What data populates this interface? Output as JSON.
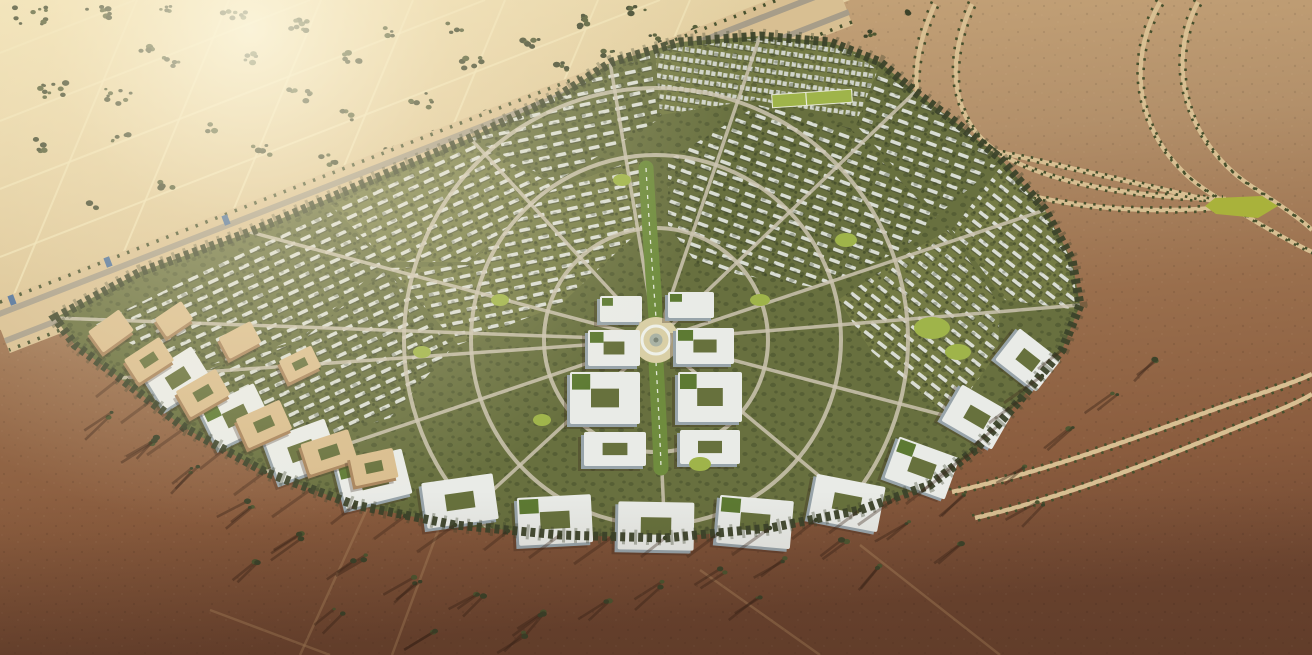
{
  "meta": {
    "type": "aerial-3d-render",
    "description": "Bird's-eye CGI rendering of a fan-shaped masterplanned desert community: dense white low-rise housing wedges with trees radiate from a circular central plaza and green promenade spine; large white office blocks line the southern arc; tan campus buildings on the west edge; a palm-lined highway corridor crosses the NW golden farm fields; S-curved tree-lined roads cross the NE desert to a small green interchange; dark red-brown desert with long tree shadows fills the south.",
    "width": 1312,
    "height": 655
  },
  "palette": {
    "desert_nw_light": "#eedfb2",
    "desert_nw": "#d2b787",
    "desert_ne": "#b3906a",
    "desert_s": "#8a5c3e",
    "desert_s_dark": "#6e4631",
    "field_line": "#efe2b6",
    "tree_dark": "#3c432a",
    "tree_mid": "#4d5631",
    "tree_shadow": "rgba(58,36,24,0.42)",
    "road_sand": "#d8bf92",
    "road_asphalt": "#a79d89",
    "road_city": "#ccc4b0",
    "palm_row": "#46502d",
    "fan_base": "#68703f",
    "fan_base2": "#747b45",
    "house_white": "#e3e6e0",
    "house_shade": "rgba(40,45,38,0.45)",
    "apt_white": "#d8dcd6",
    "campus_roof": "#e9ebe7",
    "campus_side": "#98a4aa",
    "campus_tan_roof": "#d9bd8e",
    "campus_tan_side": "#a8845c",
    "courtyard_green": "#67713d",
    "roof_garden": "#5d7a33",
    "lawn_bright": "#9fb44a",
    "spine_green": "#6f8c3e",
    "plaza_ground": "#d9cfa6",
    "plaza_ring": "#eef0e8",
    "plaza_center": "#aab3a5",
    "interchange_green": "#a9b23b",
    "structure_blue": "#4a6e9b",
    "canopy_dot": "rgba(45,55,29,0.55)",
    "glare": "#fff7dd",
    "track": "#a87f59"
  },
  "scene": {
    "fan_outline": "55,318 140,272 250,232 360,185 470,138 560,95 612,62 680,42 760,36 830,42 880,62 915,92 950,118 1000,158 1045,210 1072,260 1080,305 1062,350 1020,400 975,450 930,485 860,510 770,528 665,538 560,535 455,525 355,505 265,472 185,428 120,378 75,345",
    "nw_region": "0,0 850,0 0,330",
    "highway": {
      "band": "M 843,0 L 0,328",
      "roads": [
        "M 849,12 L 5,341",
        "M 838,-12 L -6,316"
      ],
      "palms": [
        "M 852,22 L 9,350",
        "M 834,-22 L -10,306"
      ],
      "structures": [
        [
          108,
          262
        ],
        [
          12,
          300
        ],
        [
          226,
          220
        ]
      ]
    },
    "field_lines_a": [
      [
        660,
        0,
        0,
        257
      ],
      [
        485,
        0,
        0,
        189
      ],
      [
        310,
        0,
        0,
        121
      ],
      [
        135,
        0,
        0,
        53
      ]
    ],
    "field_lines_b": [
      [
        0,
        328,
        137,
        0
      ],
      [
        110,
        285,
        229,
        0
      ],
      [
        220,
        242,
        321,
        0
      ],
      [
        330,
        200,
        413,
        0
      ],
      [
        440,
        157,
        505,
        0
      ],
      [
        550,
        114,
        598,
        0
      ],
      [
        660,
        71,
        690,
        0
      ]
    ],
    "tree_clusters_nw": [
      [
        30,
        16,
        10,
        16
      ],
      [
        100,
        12,
        8,
        14
      ],
      [
        165,
        10,
        5,
        10
      ],
      [
        235,
        16,
        7,
        12
      ],
      [
        300,
        24,
        5,
        10
      ],
      [
        350,
        58,
        6,
        11
      ],
      [
        300,
        95,
        7,
        12
      ],
      [
        250,
        58,
        5,
        9
      ],
      [
        150,
        46,
        6,
        10
      ],
      [
        55,
        90,
        10,
        15
      ],
      [
        118,
        96,
        8,
        13
      ],
      [
        172,
        62,
        5,
        9
      ],
      [
        35,
        145,
        5,
        10
      ],
      [
        120,
        140,
        5,
        9
      ],
      [
        210,
        128,
        4,
        8
      ],
      [
        262,
        150,
        5,
        9
      ],
      [
        330,
        160,
        5,
        9
      ],
      [
        392,
        150,
        4,
        8
      ],
      [
        165,
        186,
        4,
        8
      ],
      [
        95,
        205,
        3,
        7
      ],
      [
        420,
        100,
        7,
        12
      ],
      [
        345,
        115,
        5,
        9
      ],
      [
        440,
        132,
        4,
        8
      ],
      [
        490,
        115,
        4,
        7
      ],
      [
        540,
        110,
        3,
        6
      ],
      [
        472,
        62,
        6,
        10
      ],
      [
        530,
        42,
        6,
        10
      ],
      [
        585,
        22,
        7,
        11
      ],
      [
        637,
        12,
        5,
        9
      ],
      [
        455,
        28,
        5,
        8
      ],
      [
        560,
        66,
        5,
        8
      ],
      [
        610,
        52,
        4,
        7
      ],
      [
        655,
        38,
        4,
        7
      ],
      [
        700,
        28,
        4,
        7
      ],
      [
        743,
        17,
        4,
        7
      ],
      [
        788,
        10,
        4,
        7
      ],
      [
        390,
        32,
        4,
        7
      ],
      [
        300,
        28,
        4,
        7
      ],
      [
        688,
        66,
        4,
        7
      ],
      [
        640,
        82,
        4,
        7
      ],
      [
        592,
        96,
        3,
        6
      ],
      [
        835,
        22,
        5,
        8
      ],
      [
        872,
        34,
        4,
        7
      ],
      [
        908,
        14,
        3,
        6
      ],
      [
        752,
        42,
        4,
        7
      ],
      [
        710,
        55,
        3,
        6
      ],
      [
        560,
        92,
        3,
        6
      ]
    ],
    "tree_clusters_s": [
      [
        150,
        440,
        3,
        7
      ],
      [
        110,
        415,
        2,
        6
      ],
      [
        195,
        470,
        3,
        7
      ],
      [
        250,
        505,
        3,
        7
      ],
      [
        305,
        535,
        3,
        7
      ],
      [
        360,
        558,
        3,
        7
      ],
      [
        420,
        580,
        3,
        7
      ],
      [
        480,
        598,
        3,
        6
      ],
      [
        545,
        612,
        3,
        6
      ],
      [
        610,
        600,
        2,
        6
      ],
      [
        665,
        585,
        2,
        6
      ],
      [
        720,
        570,
        2,
        6
      ],
      [
        780,
        558,
        2,
        6
      ],
      [
        845,
        540,
        2,
        6
      ],
      [
        905,
        520,
        2,
        6
      ],
      [
        965,
        495,
        2,
        6
      ],
      [
        1020,
        465,
        2,
        6
      ],
      [
        1070,
        430,
        2,
        6
      ],
      [
        1115,
        395,
        2,
        6
      ],
      [
        1160,
        362,
        2,
        6
      ],
      [
        340,
        610,
        2,
        6
      ],
      [
        255,
        560,
        2,
        6
      ],
      [
        430,
        630,
        2,
        6
      ],
      [
        520,
        635,
        2,
        5
      ],
      [
        960,
        545,
        2,
        5
      ],
      [
        880,
        565,
        2,
        5
      ],
      [
        1040,
        505,
        2,
        5
      ],
      [
        760,
        600,
        2,
        5
      ]
    ],
    "ne_roads": [
      "M 935,4 C 905,70 908,135 968,172 C 1035,208 1140,215 1228,207",
      "M 972,4 C 945,65 950,122 1002,155 C 1060,188 1150,198 1226,199",
      "M 1160,2 C 1122,70 1140,148 1210,193 C 1255,222 1290,242 1312,252",
      "M 1198,2 C 1165,66 1186,140 1248,184 C 1282,206 1302,220 1312,230",
      "M 978,148 C 1040,160 1120,180 1218,202",
      "M 952,492 C 1060,468 1150,432 1235,402 C 1278,388 1300,380 1312,374",
      "M 975,518 C 1085,492 1175,452 1255,420 C 1290,406 1306,398 1312,394"
    ],
    "interchange": "1215,198 1262,196 1278,206 1258,218 1216,214 1205,206",
    "s_tracks": [
      "M 300,655 L 372,498",
      "M 392,655 L 442,520",
      "M 210,610 L 330,655",
      "M 700,570 L 820,655",
      "M 860,545 L 1000,655"
    ],
    "districts": [
      {
        "pts": "95,325 210,268 330,212 385,262 300,340 185,372",
        "pat": "rNeg25",
        "alt": 0
      },
      {
        "pts": "330,205 470,142 555,185 468,262 388,262",
        "pat": "rNeg25",
        "alt": 1
      },
      {
        "pts": "470,138 585,82 650,55 658,120 555,182",
        "pat": "rNeg12",
        "alt": 0
      },
      {
        "pts": "655,50 760,38 845,48 878,70 858,118 755,100 660,115",
        "pat": "apts",
        "alt": 1
      },
      {
        "pts": "880,72 915,95 960,125 1000,162 938,215 856,125",
        "pat": "rPos20",
        "alt": 0
      },
      {
        "pts": "1002,165 1045,212 1072,262 1078,310 1005,300 952,230",
        "pat": "rPos38",
        "alt": 1
      },
      {
        "pts": "390,268 468,265 552,190 640,158 646,225 560,305 458,345",
        "pat": "rNeg12",
        "alt": 1
      },
      {
        "pts": "668,160 758,105 850,128 936,218 902,250 818,288 700,268 668,225",
        "pat": "rPos20",
        "alt": 0
      },
      {
        "pts": "905,255 948,230 1000,305 998,352 950,418 872,352 838,300",
        "pat": "rPos38",
        "alt": 1
      },
      {
        "pts": "188,375 300,342 386,270 452,348 390,418 300,443 230,428",
        "pat": "rNeg25",
        "alt": 0
      }
    ],
    "rings": [
      112,
      185,
      252
    ],
    "plaza": {
      "cx": 656,
      "cy": 340
    },
    "radial_ends": [
      [
        55,
        318
      ],
      [
        250,
        232
      ],
      [
        470,
        138
      ],
      [
        610,
        62
      ],
      [
        760,
        36
      ],
      [
        915,
        92
      ],
      [
        1045,
        210
      ],
      [
        1080,
        305
      ],
      [
        1000,
        430
      ],
      [
        860,
        510
      ],
      [
        665,
        538
      ],
      [
        455,
        525
      ],
      [
        265,
        472
      ],
      [
        120,
        378
      ]
    ],
    "spine": [
      "M 646,168 C 650,240 654,290 656,318",
      "M 656,362 C 658,400 660,435 661,468"
    ],
    "campus_buildings": [
      [
        588,
        330,
        52,
        36,
        0,
        1,
        1
      ],
      [
        676,
        328,
        58,
        36,
        0,
        1,
        1
      ],
      [
        570,
        372,
        70,
        52,
        0,
        1,
        1
      ],
      [
        678,
        372,
        64,
        50,
        0,
        1,
        1
      ],
      [
        584,
        432,
        62,
        34,
        0,
        1,
        0
      ],
      [
        680,
        430,
        60,
        34,
        0,
        1,
        0
      ],
      [
        600,
        296,
        42,
        26,
        0,
        0,
        1
      ],
      [
        668,
        292,
        46,
        26,
        0,
        0,
        1
      ]
    ],
    "south_buildings": [
      [
        150,
        358,
        56,
        40,
        -32,
        1,
        0
      ],
      [
        206,
        394,
        60,
        44,
        -26,
        1,
        1
      ],
      [
        270,
        428,
        64,
        46,
        -20,
        1,
        0
      ],
      [
        340,
        456,
        68,
        46,
        -14,
        1,
        1
      ],
      [
        424,
        478,
        72,
        46,
        -8,
        1,
        0
      ],
      [
        518,
        496,
        74,
        48,
        -3,
        1,
        1
      ],
      [
        618,
        502,
        76,
        48,
        1,
        1,
        0
      ],
      [
        718,
        498,
        74,
        48,
        5,
        1,
        1
      ],
      [
        812,
        480,
        70,
        46,
        11,
        1,
        0
      ],
      [
        890,
        446,
        64,
        44,
        20,
        1,
        1
      ],
      [
        948,
        396,
        58,
        42,
        30,
        1,
        0
      ],
      [
        1002,
        340,
        52,
        40,
        38,
        1,
        0
      ]
    ],
    "west_buildings": [
      [
        92,
        318,
        38,
        26,
        -36,
        0,
        0
      ],
      [
        128,
        346,
        42,
        28,
        -33,
        1,
        0
      ],
      [
        180,
        378,
        46,
        30,
        -30,
        1,
        0
      ],
      [
        240,
        408,
        48,
        32,
        -24,
        1,
        0
      ],
      [
        304,
        436,
        50,
        32,
        -18,
        1,
        0
      ],
      [
        158,
        308,
        32,
        22,
        -34,
        0,
        0
      ],
      [
        222,
        328,
        36,
        24,
        -28,
        0,
        0
      ],
      [
        282,
        352,
        36,
        24,
        -26,
        1,
        0
      ],
      [
        352,
        452,
        44,
        30,
        -12,
        1,
        0
      ]
    ],
    "lawns": [
      [
        932,
        328,
        18,
        11
      ],
      [
        958,
        352,
        13,
        8
      ],
      [
        700,
        464,
        11,
        7
      ],
      [
        622,
        180,
        9,
        6
      ],
      [
        846,
        240,
        11,
        7
      ],
      [
        422,
        352,
        9,
        6
      ],
      [
        542,
        420,
        9,
        6
      ],
      [
        760,
        300,
        10,
        6
      ],
      [
        500,
        300,
        9,
        6
      ]
    ],
    "sports_field": {
      "x": 772,
      "y": 92,
      "w": 80,
      "h": 13,
      "r": -4
    },
    "south_edge": [
      [
        120,
        378
      ],
      [
        152,
        400
      ],
      [
        185,
        428
      ],
      [
        224,
        450
      ],
      [
        265,
        472
      ],
      [
        310,
        490
      ],
      [
        355,
        505
      ],
      [
        405,
        516
      ],
      [
        455,
        525
      ],
      [
        508,
        531
      ],
      [
        560,
        535
      ],
      [
        612,
        537
      ],
      [
        665,
        538
      ],
      [
        718,
        534
      ],
      [
        770,
        528
      ],
      [
        816,
        520
      ],
      [
        860,
        510
      ],
      [
        896,
        498
      ],
      [
        930,
        485
      ],
      [
        953,
        468
      ],
      [
        975,
        450
      ],
      [
        998,
        426
      ],
      [
        1020,
        400
      ],
      [
        1042,
        376
      ],
      [
        1062,
        350
      ]
    ]
  }
}
